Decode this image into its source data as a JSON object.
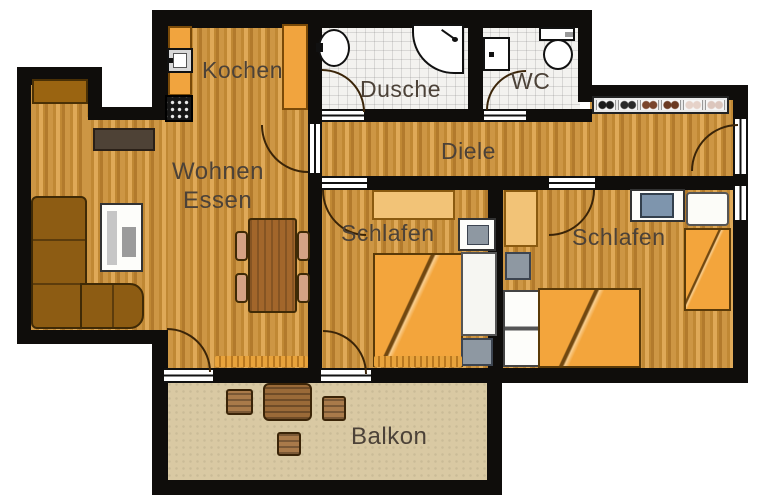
{
  "colors": {
    "wall": "#0f0d0b",
    "label": "#4c4238",
    "wood1": "#cd9644",
    "wood2": "#c08834",
    "wood3": "#dfa958",
    "tile": "#f3f2ef",
    "balconyFloor": "#d9c9a3",
    "counter": "#f1a43e",
    "wardrobe": "#f2c377",
    "bed": "#f3a53c",
    "sofa": "#8d5c13",
    "tableWood": "#a2662b",
    "chair": "#d5a284",
    "balconyWood": "#9a6a38",
    "monitor": "#7e95ad",
    "nightstand": "#8e98a2",
    "doorArc": "#3a2408"
  },
  "rooms": {
    "kitchen": {
      "label": "Kochen"
    },
    "shower_room": {
      "label": "Dusche"
    },
    "wc": {
      "label": "WC"
    },
    "hallway": {
      "label": "Diele",
      "shoe_pairs": [
        "#1c1c1c",
        "#2a2a2a",
        "#7a452c",
        "#6b3a22",
        "#e6d2c9",
        "#dcc6bd"
      ]
    },
    "living_dining": {
      "label_line1": "Wohnen",
      "label_line2": "Essen"
    },
    "bedroom_middle": {
      "label": "Schlafen"
    },
    "bedroom_right": {
      "label": "Schlafen"
    },
    "balcony": {
      "label": "Balkon"
    }
  }
}
